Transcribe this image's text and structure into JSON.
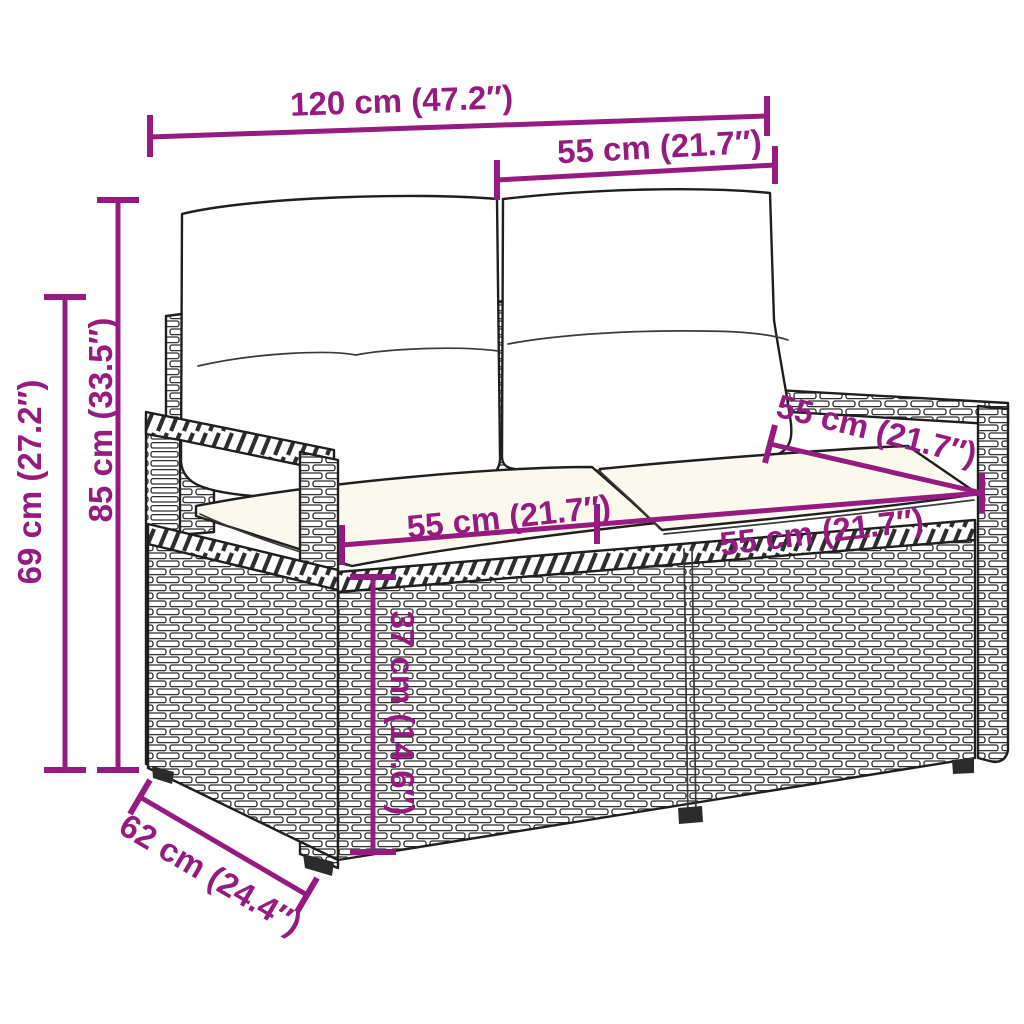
{
  "diagram": {
    "illustration": "two-seater poly rattan garden sofa with back and seat cushions",
    "background_color": "#ffffff",
    "annotation_color": "#951b81",
    "outline_color": "#1f1f1f",
    "back_cushion_color": "#ffffff",
    "seat_cushion_color": "#fbf9ee",
    "annotations": {
      "overall_width": "120 cm (47.2″)",
      "back_cushion_width": "55 cm (21.7″)",
      "total_height": "85 cm (33.5″)",
      "armrest_height": "69 cm (27.2″)",
      "seat_depth": "55 cm (21.7″)",
      "seat_width_left": "55 cm (21.7″)",
      "seat_width_right": "55 cm (21.7″)",
      "seat_height": "37 cm (14.6″)",
      "overall_depth": "62 cm (24.4″)"
    }
  }
}
